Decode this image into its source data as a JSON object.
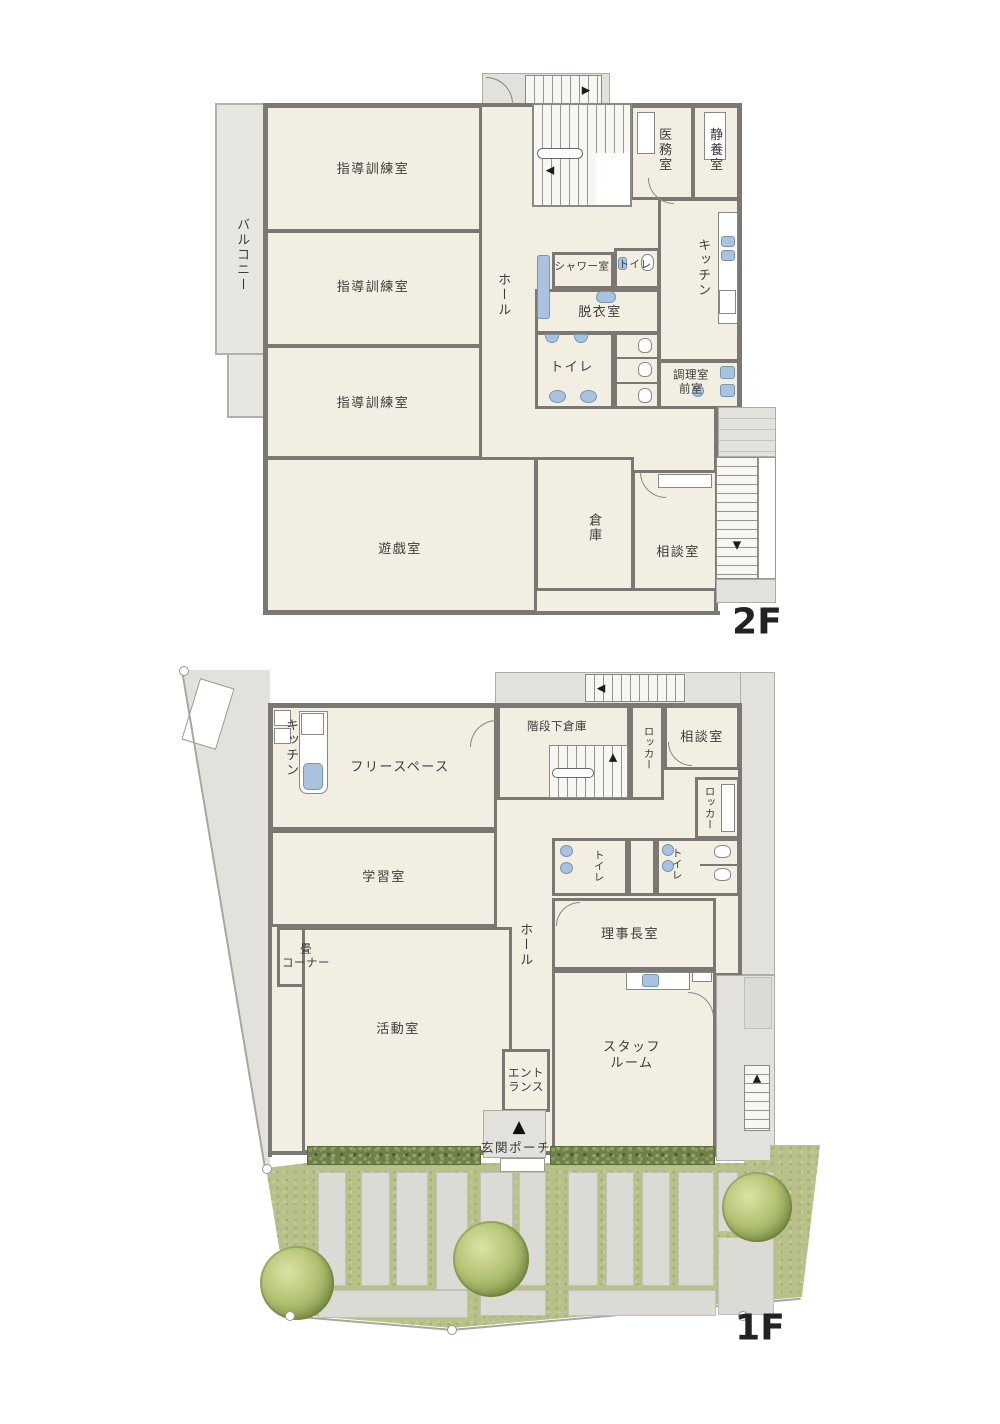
{
  "title": "建物平面図",
  "floors": [
    {
      "tag": "2F",
      "rooms": [
        {
          "label": "指導訓練室"
        },
        {
          "label": "指導訓練室"
        },
        {
          "label": "指導訓練室"
        },
        {
          "label": "バルコニー"
        },
        {
          "label": "ホール"
        },
        {
          "label": "医務室"
        },
        {
          "label": "静養室"
        },
        {
          "label": "シャワー室"
        },
        {
          "label": "トイレ"
        },
        {
          "label": "脱衣室"
        },
        {
          "label": "トイレ"
        },
        {
          "label": "キッチン"
        },
        {
          "label": "調理室\n前室"
        },
        {
          "label": "遊戯室"
        },
        {
          "label": "倉庫"
        },
        {
          "label": "相談室"
        }
      ]
    },
    {
      "tag": "1F",
      "rooms": [
        {
          "label": "キッチン"
        },
        {
          "label": "フリースペース"
        },
        {
          "label": "階段下倉庫"
        },
        {
          "label": "ロッカー"
        },
        {
          "label": "相談室"
        },
        {
          "label": "ロッカー"
        },
        {
          "label": "学習室"
        },
        {
          "label": "トイレ"
        },
        {
          "label": "トイレ"
        },
        {
          "label": "ホール"
        },
        {
          "label": "理事長室"
        },
        {
          "label": "畳\nコーナー"
        },
        {
          "label": "活動室"
        },
        {
          "label": "エント\nランス"
        },
        {
          "label": "スタッフ\nルーム"
        },
        {
          "label": "玄関ポーチ"
        }
      ]
    }
  ],
  "markers": {
    "entrance_triangle": "▲",
    "stair_up": "▲",
    "stair_down": "▼",
    "stair_left": "◀",
    "stair_right": "▶"
  },
  "colors": {
    "room_fill": "#f2eee2",
    "wall": "#7b7873",
    "exterior": "#e3e1dc",
    "fixture_blue": "#a9c3de",
    "hedge_green": "#6f8049",
    "grass_green": "#b9c08a",
    "path_grey": "#dcdad4"
  }
}
